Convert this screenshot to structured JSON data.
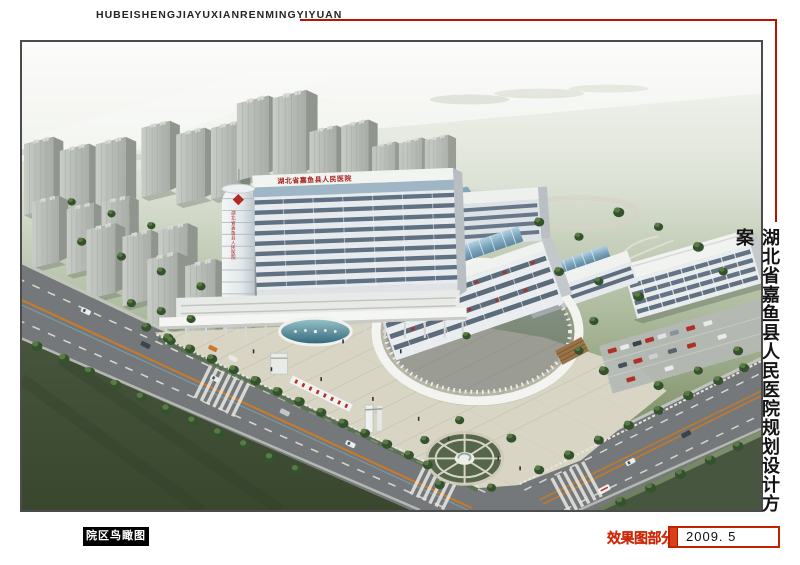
{
  "header": {
    "pinyin_title": "HUBEISHENGJIAYUXIANRENMINGYIYUAN"
  },
  "side_title": {
    "text": "湖北省嘉鱼县人民医院规划设计方案"
  },
  "footer": {
    "view_label": "院区鸟瞰图",
    "section_label": "效果图部分",
    "date": "2009. 5"
  },
  "rendering": {
    "rooftop_sign": "湖北省嘉鱼县人民医院",
    "tower_sign": "湖北省嘉鱼县人民医院"
  },
  "colors": {
    "accent_red": "#b81500",
    "stamp_red": "#d22500",
    "label_bg": "#000000",
    "glass_blue": "#7fa8be",
    "tree_green": "#35522e"
  }
}
